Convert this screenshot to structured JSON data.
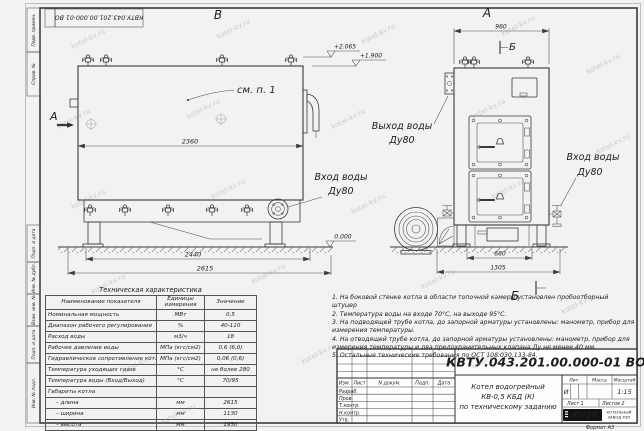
{
  "watermark": "kotel-kv.ru",
  "frame": {
    "stamp": "КВТУ.043.201.00.000-01 ВО",
    "side_labels": [
      "Перв. примен.",
      "Справ. №",
      "Подп. и дата",
      "Инв. № дубл.",
      "Взам. инв. №",
      "Подп. и дата",
      "Инв. № подл."
    ]
  },
  "views": {
    "b": {
      "title": "В",
      "section_mark": "А",
      "callout": "см. п. 1",
      "dim_inner": "2360",
      "dim_base": "2440",
      "dim_total": "2615",
      "elev1": "+2.065",
      "elev2": "+1.900",
      "elev_zero": "0.000"
    },
    "a": {
      "title": "А",
      "section_mark": "Б",
      "dim_top": "960",
      "dim_base": "660",
      "dim_total": "1305"
    }
  },
  "ports": {
    "outlet_l1": "Выход воды",
    "outlet_l2": "Ду80",
    "inlet_l1": "Вход воды",
    "inlet_l2": "Ду80"
  },
  "table": {
    "title": "Техническая характеристика",
    "headers": [
      "Наименование показателя",
      "Единицы измерения",
      "Значение"
    ],
    "rows": [
      [
        "Номинальная мощность",
        "МВт",
        "0,5"
      ],
      [
        "Диапазон рабочего регулирования",
        "%",
        "40-110"
      ],
      [
        "Расход воды",
        "м3/ч",
        "18"
      ],
      [
        "Рабочее давление воды",
        "МПа (кгс/см2)",
        "0,6 (6,0)"
      ],
      [
        "Гидравлическое сопротивление котла",
        "МПа (кгс/см2)",
        "0,06 (0,6)"
      ],
      [
        "Температура уходящих газов",
        "°С",
        "не более 280"
      ],
      [
        "Температура воды (Вход/Выход)",
        "°С",
        "70/95"
      ],
      [
        "Габариты котла",
        "",
        ""
      ],
      [
        "– длина",
        "мм",
        "2615"
      ],
      [
        "– ширина",
        "мм",
        "1130"
      ],
      [
        "– высота",
        "мм",
        "1950"
      ]
    ]
  },
  "notes": [
    "1.  На боковой стенке котла в области топочной камеры установлен пробоотборный штуцер",
    "2.  Температура воды на входе  70°С, на выходе  95°С.",
    "3.  На подводящей трубе котла, до запорной арматуры установлены: манометр, прибор для измерения температуры.",
    "4.  На отводящей трубе котла, до запорной арматуры установлены: манометр, прибор для измерения температуры и два предохранительных клапана  Ду не менее  40 мм.",
    "5.  Остальные технические требования по ОСТ 108.030.133-84."
  ],
  "title_block": {
    "doc_number": "КВТУ.043.201.00.000-01  ВО",
    "product": [
      "Котел водогрейный",
      "КВ-0,5 КБД (К)",
      "по техническому заданию"
    ],
    "rev_headers": [
      "Изм.",
      "Лист",
      "N докум.",
      "Подп.",
      "Дата"
    ],
    "sign_rows": [
      "Разраб.",
      "Пров.",
      "Т.контр.",
      "Н.контр.",
      "Утв."
    ],
    "lit_label": "Лит.",
    "mass_label": "Масса",
    "scale_label": "Масштаб",
    "lit_value": "И",
    "scale_value": "1:15",
    "sheet_label": "Лист  1",
    "sheets_label": "Листов  2",
    "logo": "KVZR",
    "company_line1": "КОТЕЛЬНЫЙ",
    "company_line2": "ЗАВОД РЭП",
    "format": "Формат  А3"
  }
}
